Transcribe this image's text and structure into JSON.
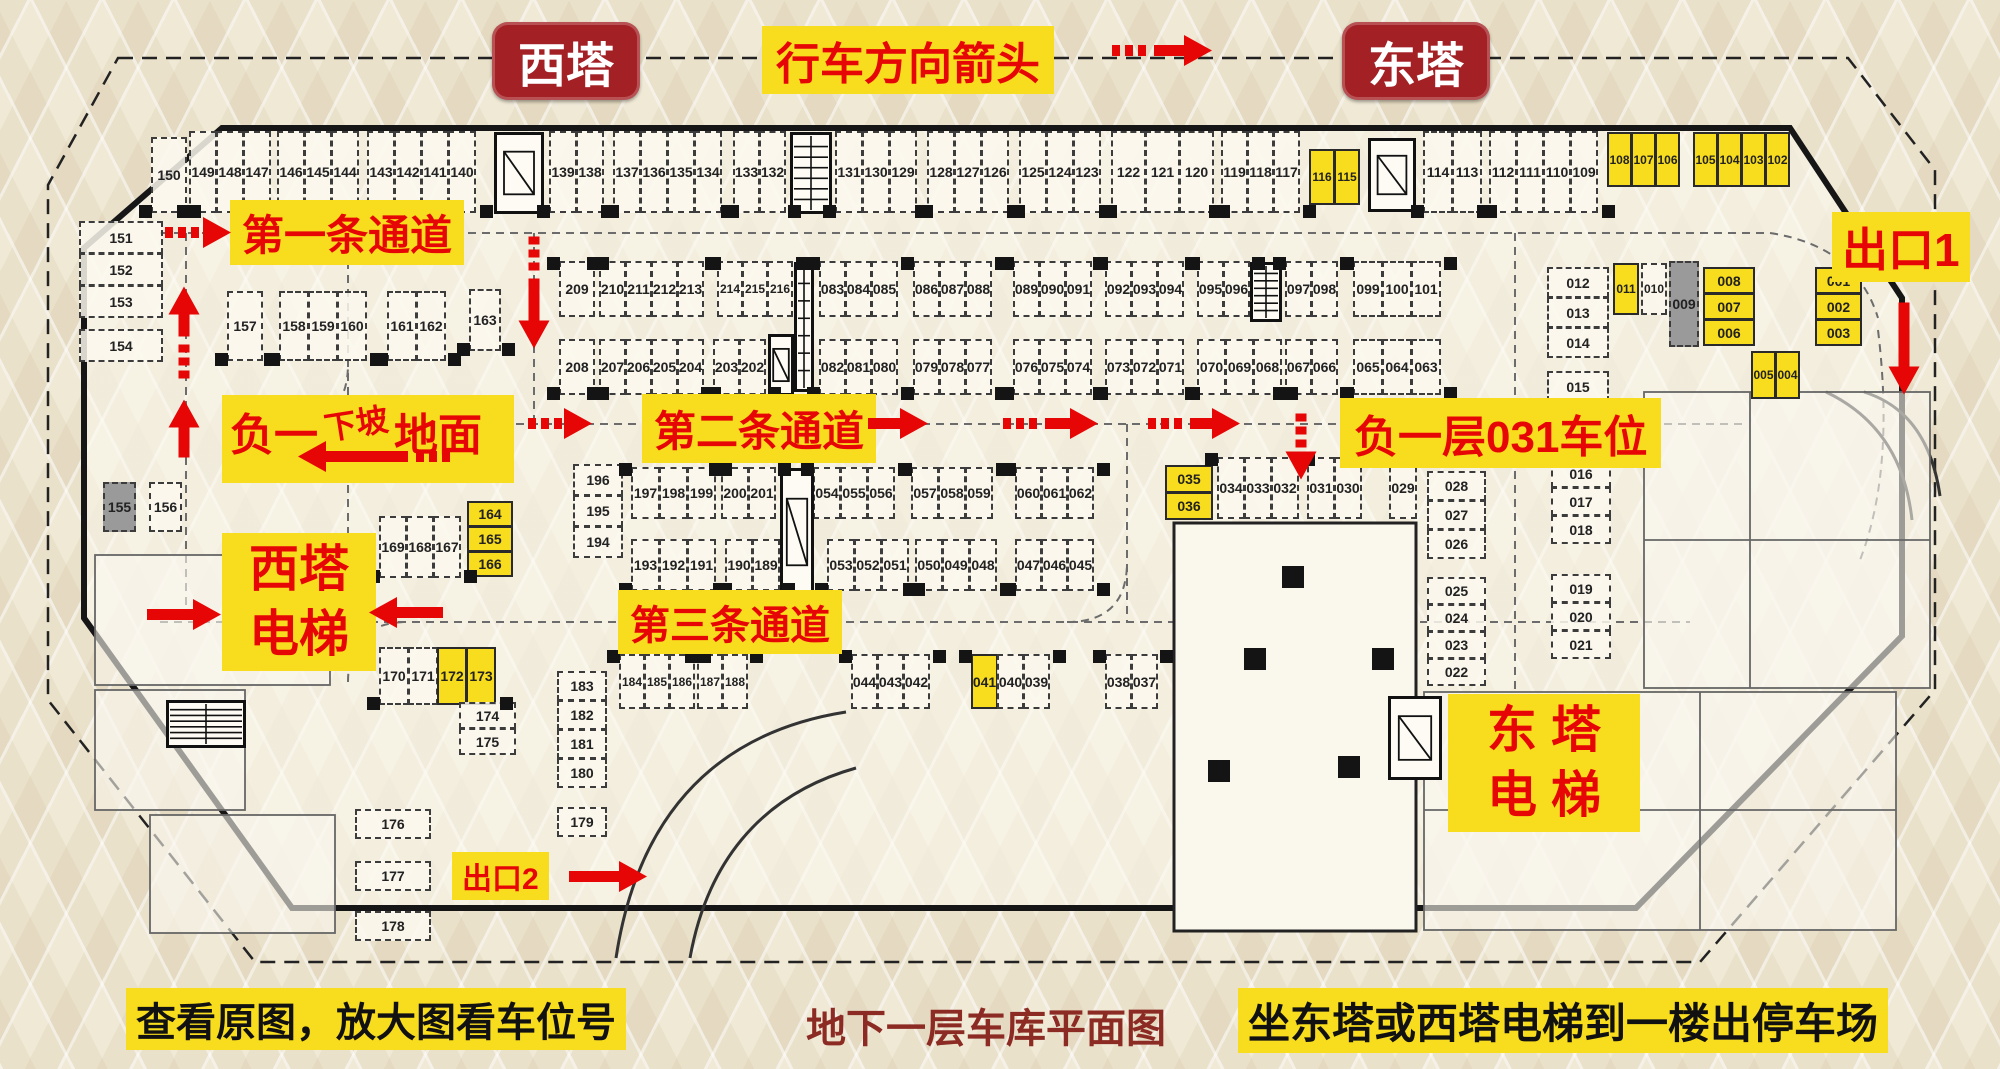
{
  "colors": {
    "highlight_yellow": "#f8dc1e",
    "label_red": "#e60606",
    "tower_red": "#a32025",
    "caption_dark_red": "#8c2b24",
    "ink": "#111111"
  },
  "labels": {
    "west_tower": "西塔",
    "east_tower": "东塔",
    "direction": "行车方向箭头",
    "lane1": "第一条通道",
    "lane2": "第二条通道",
    "lane3": "第三条通道",
    "exit1": "出口1",
    "exit2": "出口2",
    "spot031": "负一层031车位",
    "ramp_prefix": "负一",
    "ramp_slope": "下坡",
    "ramp_ground": "地面",
    "west_elevator_line1": "西塔",
    "west_elevator_line2": "电梯",
    "east_elevator_line1": "东 塔",
    "east_elevator_line2": "电 梯",
    "caption_left": "查看原图，放大图看车位号",
    "caption_center": "地下一层车库平面图",
    "caption_right": "坐东塔或西塔电梯到一楼出停车场"
  },
  "icons": [
    {
      "id": "el1",
      "kind": "elevator-icon"
    },
    {
      "id": "st1",
      "kind": "stair-icon"
    },
    {
      "id": "el2",
      "kind": "elevator-icon"
    },
    {
      "id": "st2",
      "kind": "stair-icon"
    },
    {
      "id": "st3",
      "kind": "stair-icon"
    },
    {
      "id": "el3",
      "kind": "elevator-icon"
    },
    {
      "id": "el4",
      "kind": "elevator-icon"
    },
    {
      "id": "el5",
      "kind": "elevator-icon"
    },
    {
      "id": "st4",
      "kind": "stair-icon"
    }
  ],
  "stall_groups": [
    {
      "id": "t150",
      "cells": [
        {
          "n": "150"
        }
      ]
    },
    {
      "id": "t149",
      "cells": [
        {
          "n": "149"
        },
        {
          "n": "148"
        },
        {
          "n": "147"
        }
      ]
    },
    {
      "id": "t146",
      "cells": [
        {
          "n": "146"
        },
        {
          "n": "145"
        },
        {
          "n": "144"
        }
      ]
    },
    {
      "id": "t143",
      "cells": [
        {
          "n": "143"
        },
        {
          "n": "142"
        },
        {
          "n": "141"
        },
        {
          "n": "140"
        }
      ]
    },
    {
      "id": "t139",
      "cells": [
        {
          "n": "139"
        },
        {
          "n": "138"
        }
      ]
    },
    {
      "id": "t137",
      "cells": [
        {
          "n": "137"
        },
        {
          "n": "136"
        },
        {
          "n": "135"
        },
        {
          "n": "134"
        }
      ]
    },
    {
      "id": "t133",
      "cells": [
        {
          "n": "133"
        },
        {
          "n": "132"
        }
      ]
    },
    {
      "id": "t131",
      "cells": [
        {
          "n": "131"
        },
        {
          "n": "130"
        },
        {
          "n": "129"
        }
      ]
    },
    {
      "id": "t128",
      "cells": [
        {
          "n": "128"
        },
        {
          "n": "127"
        },
        {
          "n": "126"
        }
      ]
    },
    {
      "id": "t125",
      "cells": [
        {
          "n": "125"
        },
        {
          "n": "124"
        },
        {
          "n": "123"
        }
      ]
    },
    {
      "id": "t122",
      "cells": [
        {
          "n": "122"
        },
        {
          "n": "121"
        },
        {
          "n": "120"
        }
      ]
    },
    {
      "id": "t119",
      "cells": [
        {
          "n": "119"
        },
        {
          "n": "118"
        },
        {
          "n": "117"
        }
      ]
    },
    {
      "id": "t116",
      "cells": [
        {
          "n": "116",
          "hl": true
        },
        {
          "n": "115",
          "hl": true
        }
      ]
    },
    {
      "id": "t114",
      "cells": [
        {
          "n": "114"
        },
        {
          "n": "113"
        }
      ]
    },
    {
      "id": "t112",
      "cells": [
        {
          "n": "112"
        },
        {
          "n": "111"
        },
        {
          "n": "110"
        },
        {
          "n": "109"
        }
      ]
    },
    {
      "id": "t108",
      "cells": [
        {
          "n": "108",
          "hl": true
        },
        {
          "n": "107",
          "hl": true
        },
        {
          "n": "106",
          "hl": true
        }
      ]
    },
    {
      "id": "t105",
      "cells": [
        {
          "n": "105",
          "hl": true
        },
        {
          "n": "104",
          "hl": true
        },
        {
          "n": "103",
          "hl": true
        },
        {
          "n": "102",
          "hl": true
        }
      ]
    },
    {
      "id": "l151",
      "cells": [
        {
          "n": "151"
        },
        {
          "n": "152"
        },
        {
          "n": "153"
        }
      ]
    },
    {
      "id": "l154",
      "cells": [
        {
          "n": "154"
        }
      ]
    },
    {
      "id": "s157",
      "cells": [
        {
          "n": "157"
        }
      ]
    },
    {
      "id": "s158",
      "cells": [
        {
          "n": "158"
        },
        {
          "n": "159"
        },
        {
          "n": "160"
        }
      ]
    },
    {
      "id": "s161",
      "cells": [
        {
          "n": "161"
        },
        {
          "n": "162"
        }
      ]
    },
    {
      "id": "s163",
      "cells": [
        {
          "n": "163"
        }
      ]
    },
    {
      "id": "a209",
      "cells": [
        {
          "n": "209"
        }
      ]
    },
    {
      "id": "a210",
      "cells": [
        {
          "n": "210"
        },
        {
          "n": "211"
        },
        {
          "n": "212"
        },
        {
          "n": "213"
        }
      ]
    },
    {
      "id": "a214",
      "cells": [
        {
          "n": "214"
        },
        {
          "n": "215"
        },
        {
          "n": "216"
        }
      ]
    },
    {
      "id": "a083",
      "cells": [
        {
          "n": "083"
        },
        {
          "n": "084"
        },
        {
          "n": "085"
        }
      ]
    },
    {
      "id": "a086",
      "cells": [
        {
          "n": "086"
        },
        {
          "n": "087"
        },
        {
          "n": "088"
        }
      ]
    },
    {
      "id": "a089",
      "cells": [
        {
          "n": "089"
        },
        {
          "n": "090"
        },
        {
          "n": "091"
        }
      ]
    },
    {
      "id": "a092",
      "cells": [
        {
          "n": "092"
        },
        {
          "n": "093"
        },
        {
          "n": "094"
        }
      ]
    },
    {
      "id": "a095",
      "cells": [
        {
          "n": "095"
        },
        {
          "n": "096"
        }
      ]
    },
    {
      "id": "a097",
      "cells": [
        {
          "n": "097"
        },
        {
          "n": "098"
        }
      ]
    },
    {
      "id": "a099",
      "cells": [
        {
          "n": "099"
        },
        {
          "n": "100"
        },
        {
          "n": "101"
        }
      ]
    },
    {
      "id": "b208",
      "cells": [
        {
          "n": "208"
        }
      ]
    },
    {
      "id": "b207",
      "cells": [
        {
          "n": "207"
        },
        {
          "n": "206"
        },
        {
          "n": "205"
        },
        {
          "n": "204"
        }
      ]
    },
    {
      "id": "b203",
      "cells": [
        {
          "n": "203"
        },
        {
          "n": "202"
        }
      ]
    },
    {
      "id": "b082",
      "cells": [
        {
          "n": "082"
        },
        {
          "n": "081"
        },
        {
          "n": "080"
        }
      ]
    },
    {
      "id": "b079",
      "cells": [
        {
          "n": "079"
        },
        {
          "n": "078"
        },
        {
          "n": "077"
        }
      ]
    },
    {
      "id": "b076",
      "cells": [
        {
          "n": "076"
        },
        {
          "n": "075"
        },
        {
          "n": "074"
        }
      ]
    },
    {
      "id": "b073",
      "cells": [
        {
          "n": "073"
        },
        {
          "n": "072"
        },
        {
          "n": "071"
        }
      ]
    },
    {
      "id": "b070",
      "cells": [
        {
          "n": "070"
        },
        {
          "n": "069"
        },
        {
          "n": "068"
        }
      ]
    },
    {
      "id": "b067",
      "cells": [
        {
          "n": "067"
        },
        {
          "n": "066"
        }
      ]
    },
    {
      "id": "b065",
      "cells": [
        {
          "n": "065"
        },
        {
          "n": "064"
        },
        {
          "n": "063"
        }
      ]
    },
    {
      "id": "r012",
      "cells": [
        {
          "n": "012"
        },
        {
          "n": "013"
        },
        {
          "n": "014"
        }
      ]
    },
    {
      "id": "r015",
      "cells": [
        {
          "n": "015"
        }
      ]
    },
    {
      "id": "r011",
      "cells": [
        {
          "n": "011",
          "hl": true
        }
      ]
    },
    {
      "id": "r010",
      "cells": [
        {
          "n": "010"
        }
      ]
    },
    {
      "id": "r009",
      "cells": [
        {
          "n": "009",
          "gray": true
        }
      ]
    },
    {
      "id": "r008",
      "cells": [
        {
          "n": "008",
          "hl": true
        },
        {
          "n": "007",
          "hl": true
        },
        {
          "n": "006",
          "hl": true
        }
      ]
    },
    {
      "id": "r001",
      "cells": [
        {
          "n": "001",
          "hl": true
        },
        {
          "n": "002",
          "hl": true
        },
        {
          "n": "003",
          "hl": true
        }
      ]
    },
    {
      "id": "r005",
      "cells": [
        {
          "n": "005",
          "hl": true
        },
        {
          "n": "004",
          "hl": true
        }
      ]
    },
    {
      "id": "m155",
      "cells": [
        {
          "n": "155",
          "gray": true
        }
      ]
    },
    {
      "id": "m156",
      "cells": [
        {
          "n": "156"
        }
      ]
    },
    {
      "id": "m169",
      "cells": [
        {
          "n": "169"
        },
        {
          "n": "168"
        },
        {
          "n": "167"
        }
      ]
    },
    {
      "id": "m164",
      "cells": [
        {
          "n": "164",
          "hl": true
        },
        {
          "n": "165",
          "hl": true
        },
        {
          "n": "166",
          "hl": true
        }
      ]
    },
    {
      "id": "m170",
      "cells": [
        {
          "n": "170"
        },
        {
          "n": "171"
        },
        {
          "n": "172",
          "hl": true
        },
        {
          "n": "173",
          "hl": true
        }
      ]
    },
    {
      "id": "m174",
      "cells": [
        {
          "n": "174"
        },
        {
          "n": "175"
        }
      ]
    },
    {
      "id": "m176",
      "cells": [
        {
          "n": "176"
        }
      ]
    },
    {
      "id": "m177",
      "cells": [
        {
          "n": "177"
        }
      ]
    },
    {
      "id": "m178",
      "cells": [
        {
          "n": "178"
        }
      ]
    },
    {
      "id": "c196",
      "cells": [
        {
          "n": "196"
        },
        {
          "n": "195"
        },
        {
          "n": "194"
        }
      ]
    },
    {
      "id": "c197",
      "cells": [
        {
          "n": "197"
        },
        {
          "n": "198"
        },
        {
          "n": "199"
        }
      ]
    },
    {
      "id": "c200",
      "cells": [
        {
          "n": "200"
        },
        {
          "n": "201"
        }
      ]
    },
    {
      "id": "c054",
      "cells": [
        {
          "n": "054"
        },
        {
          "n": "055"
        },
        {
          "n": "056"
        }
      ]
    },
    {
      "id": "c057",
      "cells": [
        {
          "n": "057"
        },
        {
          "n": "058"
        },
        {
          "n": "059"
        }
      ]
    },
    {
      "id": "c060",
      "cells": [
        {
          "n": "060"
        },
        {
          "n": "061"
        },
        {
          "n": "062"
        }
      ]
    },
    {
      "id": "y035",
      "cells": [
        {
          "n": "035",
          "hl": true
        },
        {
          "n": "036",
          "hl": true
        }
      ]
    },
    {
      "id": "c034",
      "cells": [
        {
          "n": "034"
        },
        {
          "n": "033"
        },
        {
          "n": "032"
        }
      ]
    },
    {
      "id": "c031",
      "cells": [
        {
          "n": "031"
        },
        {
          "n": "030"
        }
      ]
    },
    {
      "id": "c029",
      "cells": [
        {
          "n": "029"
        }
      ]
    },
    {
      "id": "c193",
      "cells": [
        {
          "n": "193"
        },
        {
          "n": "192"
        },
        {
          "n": "191"
        }
      ]
    },
    {
      "id": "c190",
      "cells": [
        {
          "n": "190"
        },
        {
          "n": "189"
        }
      ]
    },
    {
      "id": "c053",
      "cells": [
        {
          "n": "053"
        },
        {
          "n": "052"
        },
        {
          "n": "051"
        }
      ]
    },
    {
      "id": "c050",
      "cells": [
        {
          "n": "050"
        },
        {
          "n": "049"
        },
        {
          "n": "048"
        }
      ]
    },
    {
      "id": "c047",
      "cells": [
        {
          "n": "047"
        },
        {
          "n": "046"
        },
        {
          "n": "045"
        }
      ]
    },
    {
      "id": "r028",
      "cells": [
        {
          "n": "028"
        },
        {
          "n": "027"
        },
        {
          "n": "026"
        }
      ]
    },
    {
      "id": "r025",
      "cells": [
        {
          "n": "025"
        },
        {
          "n": "024"
        },
        {
          "n": "023"
        },
        {
          "n": "022"
        }
      ]
    },
    {
      "id": "r016",
      "cells": [
        {
          "n": "016"
        },
        {
          "n": "017"
        },
        {
          "n": "018"
        }
      ]
    },
    {
      "id": "r019",
      "cells": [
        {
          "n": "019"
        },
        {
          "n": "020"
        },
        {
          "n": "021"
        }
      ]
    },
    {
      "id": "d183",
      "cells": [
        {
          "n": "183"
        },
        {
          "n": "182"
        },
        {
          "n": "181"
        },
        {
          "n": "180"
        }
      ]
    },
    {
      "id": "d179",
      "cells": [
        {
          "n": "179"
        }
      ]
    },
    {
      "id": "d184",
      "cells": [
        {
          "n": "184"
        },
        {
          "n": "185"
        },
        {
          "n": "186"
        }
      ]
    },
    {
      "id": "d187",
      "cells": [
        {
          "n": "187"
        },
        {
          "n": "188"
        }
      ]
    },
    {
      "id": "d044",
      "cells": [
        {
          "n": "044"
        },
        {
          "n": "043"
        },
        {
          "n": "042"
        }
      ]
    },
    {
      "id": "d041",
      "cells": [
        {
          "n": "041",
          "hl": true
        },
        {
          "n": "040"
        },
        {
          "n": "039"
        }
      ]
    },
    {
      "id": "d038",
      "cells": [
        {
          "n": "038"
        },
        {
          "n": "037"
        }
      ]
    }
  ]
}
